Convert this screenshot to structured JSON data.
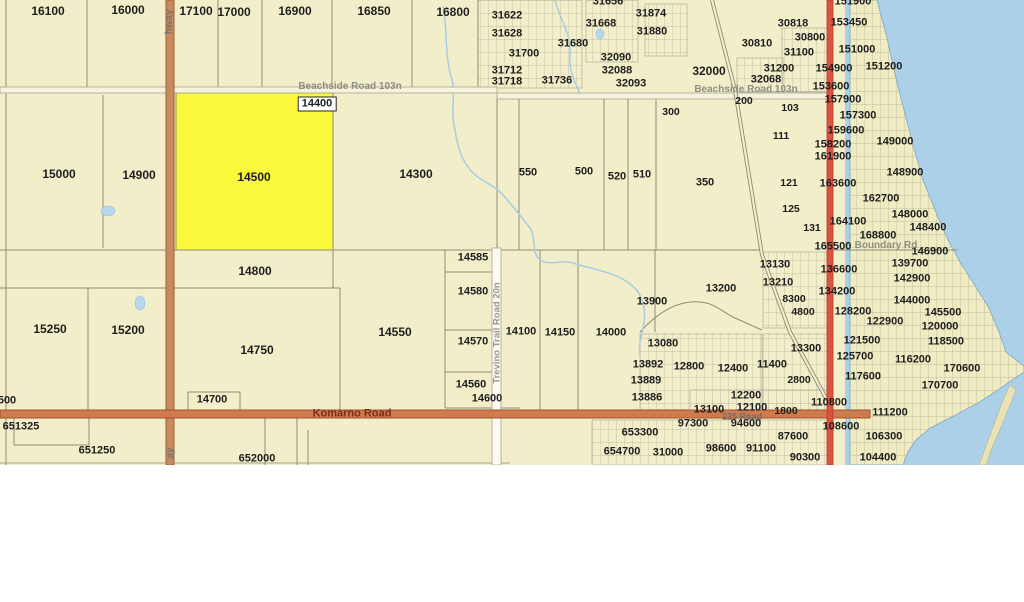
{
  "map": {
    "selected_parcel": "14500",
    "colors": {
      "land": "#f1eec9",
      "water": "#abd0e7",
      "highlight": "#f9f83b",
      "highway_orange": "#c98a5e",
      "road_orange": "#d07b4e",
      "road_red": "#df5240",
      "parcel_line": "#8f8c78",
      "dense_block": "#edeabf"
    },
    "boxed_labels": [
      {
        "t": "14400",
        "x": 317,
        "y": 104
      }
    ],
    "road_labels": [
      {
        "t": "Beachside Road 103n",
        "x": 350,
        "y": 87,
        "s": 10,
        "c": "#8f8f85"
      },
      {
        "t": "Beachside Road 103n",
        "x": 746,
        "y": 90,
        "s": 10,
        "c": "#8f8f85"
      },
      {
        "t": "Komarno Road",
        "x": 352,
        "y": 414,
        "s": 11,
        "c": "#7d2c1e"
      },
      {
        "t": "225 Road",
        "x": 742,
        "y": 417,
        "s": 9,
        "c": "#6f6f68"
      },
      {
        "t": "Trevino Trail Road 20n",
        "x": 497,
        "y": 333,
        "s": 9.5,
        "c": "#9a988c",
        "r": -90
      },
      {
        "t": "Boundary Rd",
        "x": 886,
        "y": 246,
        "s": 10,
        "c": "#8f8f85"
      },
      {
        "t": "hway",
        "x": 170,
        "y": 22,
        "s": 10,
        "c": "#75756d",
        "r": -90
      },
      {
        "t": "ay",
        "x": 171,
        "y": 453,
        "s": 10,
        "c": "#75756d",
        "r": -90
      }
    ],
    "parcel_labels": [
      {
        "t": "16100",
        "x": 48,
        "y": 11,
        "s": 12
      },
      {
        "t": "16000",
        "x": 128,
        "y": 10,
        "s": 12
      },
      {
        "t": "17100",
        "x": 196,
        "y": 11,
        "s": 12
      },
      {
        "t": "17000",
        "x": 234,
        "y": 12,
        "s": 12
      },
      {
        "t": "16900",
        "x": 295,
        "y": 11,
        "s": 12
      },
      {
        "t": "16850",
        "x": 374,
        "y": 11,
        "s": 12
      },
      {
        "t": "16800",
        "x": 453,
        "y": 12,
        "s": 12
      },
      {
        "t": "31622",
        "x": 507,
        "y": 16
      },
      {
        "t": "31628",
        "x": 507,
        "y": 34
      },
      {
        "t": "31656",
        "x": 608,
        "y": 2
      },
      {
        "t": "31668",
        "x": 601,
        "y": 24
      },
      {
        "t": "31874",
        "x": 651,
        "y": 14
      },
      {
        "t": "31880",
        "x": 652,
        "y": 32
      },
      {
        "t": "31680",
        "x": 573,
        "y": 44
      },
      {
        "t": "31700",
        "x": 524,
        "y": 54
      },
      {
        "t": "32090",
        "x": 616,
        "y": 58
      },
      {
        "t": "31712",
        "x": 507,
        "y": 71
      },
      {
        "t": "32088",
        "x": 617,
        "y": 71
      },
      {
        "t": "31736",
        "x": 557,
        "y": 81
      },
      {
        "t": "31718",
        "x": 507,
        "y": 82
      },
      {
        "t": "32093",
        "x": 631,
        "y": 84
      },
      {
        "t": "300",
        "x": 671,
        "y": 112,
        "s": 10.5
      },
      {
        "t": "30818",
        "x": 793,
        "y": 24
      },
      {
        "t": "153450",
        "x": 849,
        "y": 23
      },
      {
        "t": "30800",
        "x": 810,
        "y": 38
      },
      {
        "t": "30810",
        "x": 757,
        "y": 44
      },
      {
        "t": "31100",
        "x": 799,
        "y": 53
      },
      {
        "t": "151000",
        "x": 857,
        "y": 50
      },
      {
        "t": "151200",
        "x": 884,
        "y": 67
      },
      {
        "t": "151900",
        "x": 853,
        "y": 2
      },
      {
        "t": "32000",
        "x": 709,
        "y": 71,
        "s": 12
      },
      {
        "t": "31200",
        "x": 779,
        "y": 69
      },
      {
        "t": "154900",
        "x": 834,
        "y": 69
      },
      {
        "t": "32068",
        "x": 766,
        "y": 80
      },
      {
        "t": "153600",
        "x": 831,
        "y": 87
      },
      {
        "t": "200",
        "x": 744,
        "y": 101,
        "s": 10.5
      },
      {
        "t": "103",
        "x": 790,
        "y": 108,
        "s": 10.5
      },
      {
        "t": "111",
        "x": 781,
        "y": 136,
        "s": 10.5
      },
      {
        "t": "121",
        "x": 789,
        "y": 183,
        "s": 10.5
      },
      {
        "t": "125",
        "x": 791,
        "y": 209,
        "s": 10.5
      },
      {
        "t": "131",
        "x": 812,
        "y": 228,
        "s": 10.5
      },
      {
        "t": "350",
        "x": 705,
        "y": 183
      },
      {
        "t": "157900",
        "x": 843,
        "y": 100
      },
      {
        "t": "157300",
        "x": 858,
        "y": 116
      },
      {
        "t": "159600",
        "x": 846,
        "y": 131
      },
      {
        "t": "158200",
        "x": 833,
        "y": 145
      },
      {
        "t": "149000",
        "x": 895,
        "y": 142
      },
      {
        "t": "161900",
        "x": 833,
        "y": 157
      },
      {
        "t": "148900",
        "x": 905,
        "y": 173
      },
      {
        "t": "163600",
        "x": 838,
        "y": 184
      },
      {
        "t": "162700",
        "x": 881,
        "y": 199
      },
      {
        "t": "164100",
        "x": 848,
        "y": 222
      },
      {
        "t": "148000",
        "x": 910,
        "y": 215
      },
      {
        "t": "148400",
        "x": 928,
        "y": 228
      },
      {
        "t": "168800",
        "x": 878,
        "y": 236
      },
      {
        "t": "165500",
        "x": 833,
        "y": 247
      },
      {
        "t": "146900",
        "x": 930,
        "y": 252
      },
      {
        "t": "15000",
        "x": 59,
        "y": 174,
        "s": 12
      },
      {
        "t": "14900",
        "x": 139,
        "y": 175,
        "s": 12
      },
      {
        "t": "14500",
        "x": 254,
        "y": 177,
        "s": 12
      },
      {
        "t": "14300",
        "x": 416,
        "y": 174,
        "s": 12
      },
      {
        "t": "550",
        "x": 528,
        "y": 173
      },
      {
        "t": "500",
        "x": 584,
        "y": 172
      },
      {
        "t": "520",
        "x": 617,
        "y": 177
      },
      {
        "t": "510",
        "x": 642,
        "y": 175
      },
      {
        "t": "14800",
        "x": 255,
        "y": 271,
        "s": 12
      },
      {
        "t": "14585",
        "x": 473,
        "y": 258
      },
      {
        "t": "14580",
        "x": 473,
        "y": 292
      },
      {
        "t": "14570",
        "x": 473,
        "y": 342
      },
      {
        "t": "14560",
        "x": 471,
        "y": 385
      },
      {
        "t": "14600",
        "x": 487,
        "y": 399
      },
      {
        "t": "14100",
        "x": 521,
        "y": 332
      },
      {
        "t": "14150",
        "x": 560,
        "y": 333
      },
      {
        "t": "14000",
        "x": 611,
        "y": 333
      },
      {
        "t": "13900",
        "x": 652,
        "y": 302
      },
      {
        "t": "13200",
        "x": 721,
        "y": 289
      },
      {
        "t": "13130",
        "x": 775,
        "y": 265
      },
      {
        "t": "13210",
        "x": 778,
        "y": 283
      },
      {
        "t": "8300",
        "x": 794,
        "y": 299,
        "s": 10.5
      },
      {
        "t": "4800",
        "x": 803,
        "y": 312,
        "s": 10.5
      },
      {
        "t": "13300",
        "x": 806,
        "y": 349
      },
      {
        "t": "13080",
        "x": 663,
        "y": 344
      },
      {
        "t": "13892",
        "x": 648,
        "y": 365
      },
      {
        "t": "12800",
        "x": 689,
        "y": 367
      },
      {
        "t": "12400",
        "x": 733,
        "y": 369
      },
      {
        "t": "11400",
        "x": 772,
        "y": 365
      },
      {
        "t": "13889",
        "x": 646,
        "y": 381
      },
      {
        "t": "2800",
        "x": 799,
        "y": 380,
        "s": 10.5
      },
      {
        "t": "13886",
        "x": 647,
        "y": 398
      },
      {
        "t": "12200",
        "x": 746,
        "y": 396
      },
      {
        "t": "139700",
        "x": 910,
        "y": 264
      },
      {
        "t": "136600",
        "x": 839,
        "y": 270
      },
      {
        "t": "142900",
        "x": 912,
        "y": 279
      },
      {
        "t": "134200",
        "x": 837,
        "y": 292
      },
      {
        "t": "144000",
        "x": 912,
        "y": 301
      },
      {
        "t": "128200",
        "x": 853,
        "y": 312
      },
      {
        "t": "145500",
        "x": 943,
        "y": 313
      },
      {
        "t": "122900",
        "x": 885,
        "y": 322
      },
      {
        "t": "120000",
        "x": 940,
        "y": 327
      },
      {
        "t": "121500",
        "x": 862,
        "y": 341
      },
      {
        "t": "118500",
        "x": 946,
        "y": 342
      },
      {
        "t": "125700",
        "x": 855,
        "y": 357
      },
      {
        "t": "116200",
        "x": 913,
        "y": 360
      },
      {
        "t": "170600",
        "x": 962,
        "y": 369
      },
      {
        "t": "117600",
        "x": 863,
        "y": 377
      },
      {
        "t": "170700",
        "x": 940,
        "y": 386
      },
      {
        "t": "15250",
        "x": 50,
        "y": 329,
        "s": 12
      },
      {
        "t": "15200",
        "x": 128,
        "y": 330,
        "s": 12
      },
      {
        "t": "14750",
        "x": 257,
        "y": 350,
        "s": 12
      },
      {
        "t": "14550",
        "x": 395,
        "y": 332,
        "s": 12
      },
      {
        "t": "14700",
        "x": 212,
        "y": 400
      },
      {
        "t": "500",
        "x": 7,
        "y": 401
      },
      {
        "t": "110800",
        "x": 829,
        "y": 403
      },
      {
        "t": "111200",
        "x": 890,
        "y": 413
      },
      {
        "t": "108600",
        "x": 841,
        "y": 427
      },
      {
        "t": "106300",
        "x": 884,
        "y": 437
      },
      {
        "t": "104400",
        "x": 878,
        "y": 458
      },
      {
        "t": "87600",
        "x": 793,
        "y": 437
      },
      {
        "t": "90300",
        "x": 805,
        "y": 458
      },
      {
        "t": "98600",
        "x": 721,
        "y": 449
      },
      {
        "t": "91100",
        "x": 761,
        "y": 449
      },
      {
        "t": "97300",
        "x": 693,
        "y": 424
      },
      {
        "t": "94600",
        "x": 746,
        "y": 424
      },
      {
        "t": "13100",
        "x": 709,
        "y": 410
      },
      {
        "t": "12100",
        "x": 752,
        "y": 408
      },
      {
        "t": "1800",
        "x": 786,
        "y": 411,
        "s": 10.5
      },
      {
        "t": "651325",
        "x": 21,
        "y": 427
      },
      {
        "t": "651250",
        "x": 97,
        "y": 451
      },
      {
        "t": "652000",
        "x": 257,
        "y": 459
      },
      {
        "t": "653300",
        "x": 640,
        "y": 433
      },
      {
        "t": "654700",
        "x": 622,
        "y": 452
      },
      {
        "t": "31000",
        "x": 668,
        "y": 453
      }
    ]
  }
}
